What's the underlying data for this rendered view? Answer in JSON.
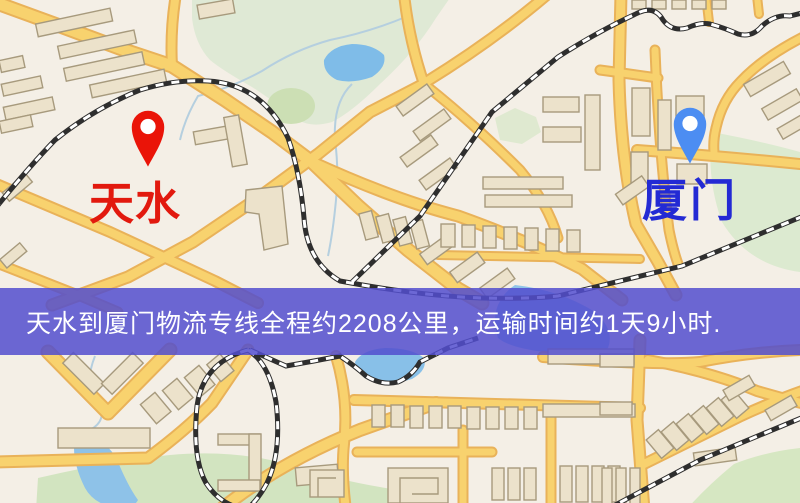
{
  "banner": {
    "text": "天水到厦门物流专线全程约2208公里，运输时间约1天9小时.",
    "bg_color": "#524ece",
    "text_color": "#ffffff"
  },
  "markers": {
    "origin": {
      "label": "天水",
      "pin_color": "#ea1408",
      "label_color": "#e2190e"
    },
    "destination": {
      "label": "厦门",
      "pin_color": "#4c8df2",
      "label_color": "#232ad4"
    }
  },
  "map_colors": {
    "background": "#f4efe6",
    "road_fill": "#f8d26e",
    "road_casing": "#e9b259",
    "park": "#dcead2",
    "water": "#85bfe8",
    "building": "#ece2cb",
    "building_outline": "#a79a7d",
    "railway": "#2e2e2e"
  }
}
